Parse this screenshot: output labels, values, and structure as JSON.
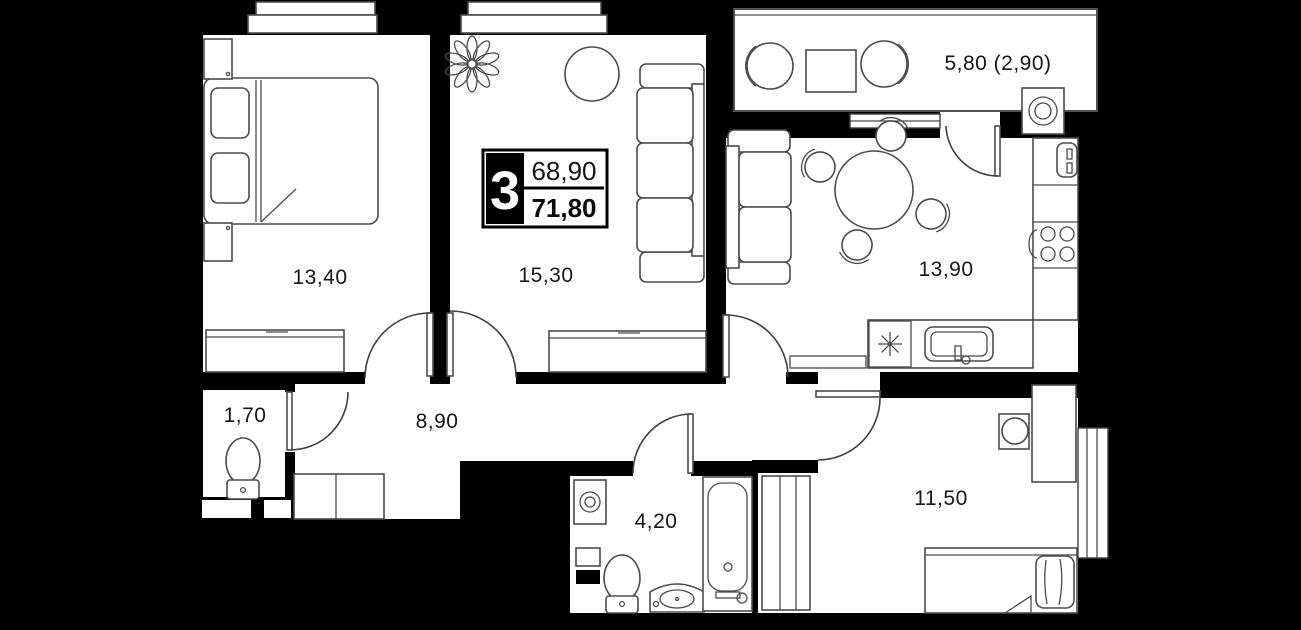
{
  "floor_plan": {
    "unit_card": {
      "rooms_count": "3",
      "area_top": "68,90",
      "area_bottom": "71,80"
    },
    "room_labels": {
      "bedroom_main": "13,40",
      "living_room": "15,30",
      "kitchen_living": "13,90",
      "balcony": "5,80 (2,90)",
      "wc": "1,70",
      "hallway": "8,90",
      "bathroom": "4,20",
      "bedroom_second": "11,50"
    },
    "colors": {
      "background": "#000000",
      "walls": "#000000",
      "floor": "#ffffff",
      "furniture_line": "#4b4b4b",
      "label_text": "#161616"
    }
  }
}
